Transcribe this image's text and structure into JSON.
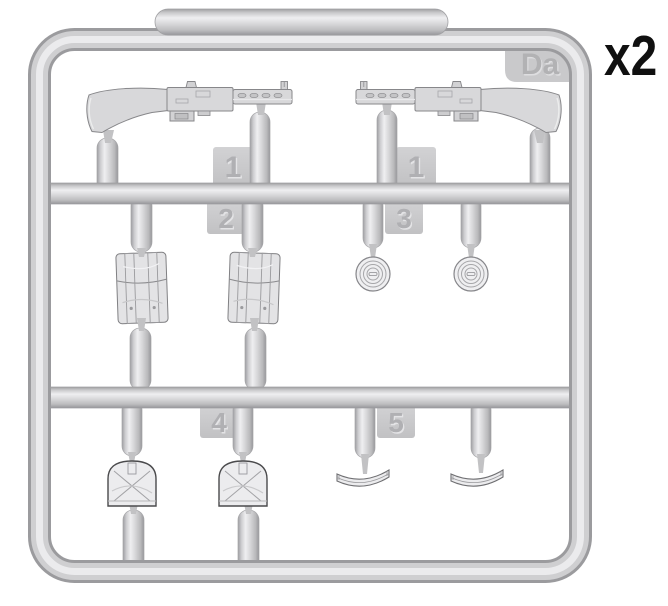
{
  "sprue": {
    "letter": "Da",
    "quantity": "x2",
    "tags": {
      "t1a": "1",
      "t1b": "1",
      "t2": "2",
      "t3": "3",
      "t4": "4",
      "t5": "5"
    },
    "parts": [
      {
        "tag": "1",
        "name": "submachine-gun",
        "count": 2
      },
      {
        "tag": "2",
        "name": "ammo-pouch",
        "count": 2
      },
      {
        "tag": "3",
        "name": "drum-magazine",
        "count": 2
      },
      {
        "tag": "4",
        "name": "magazine-pouch",
        "count": 2
      },
      {
        "tag": "5",
        "name": "curved-box-magazine",
        "count": 2
      }
    ],
    "colors": {
      "background": "#ffffff",
      "plastic": "#cfcfd1",
      "plastic_highlight": "#ebebed",
      "plastic_shadow": "#9b9b9e",
      "quantity_text": "#101010"
    }
  }
}
